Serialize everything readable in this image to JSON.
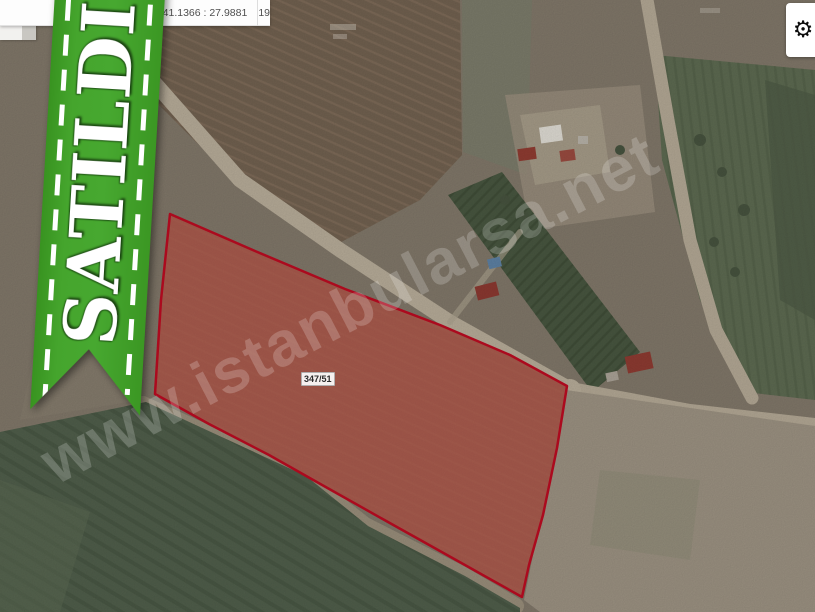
{
  "titlebar": {
    "coordinates": "41.1366 : 27.9881",
    "zoom_level": "19"
  },
  "ribbon": {
    "label": "SATILDI"
  },
  "parcel": {
    "label": "347/51"
  },
  "watermark": {
    "text": "www.istanbularsa.net"
  },
  "icons": {
    "settings_gear": "⚙"
  },
  "colors": {
    "ribbon_green": "#43a22c",
    "parcel_fill": "#cd3e34",
    "parcel_fill_opacity": "0.40",
    "parcel_stroke": "#ab0a1e",
    "topbar_background": "#fdfdfd",
    "watermark_color": "rgba(255,255,255,0.20)"
  }
}
